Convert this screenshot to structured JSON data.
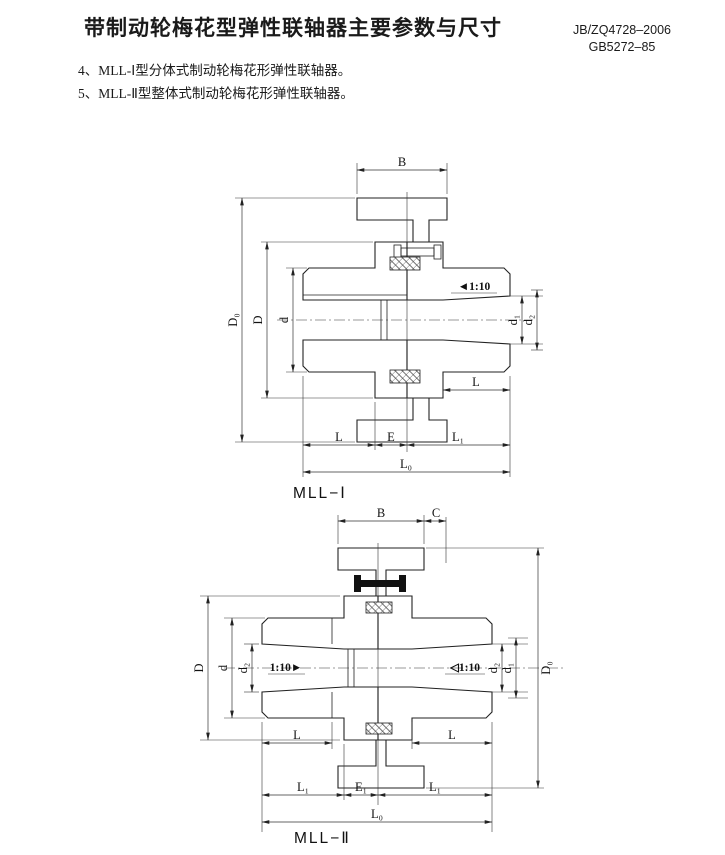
{
  "page": {
    "title": "带制动轮梅花型弹性联轴器主要参数与尺寸",
    "standards": [
      "JB/ZQ4728–2006",
      "GB5272–85"
    ]
  },
  "notes": [
    "4、MLL-Ⅰ型分体式制动轮梅花形弹性联轴器。",
    "5、MLL-Ⅱ型整体式制动轮梅花形弹性联轴器。"
  ],
  "colors": {
    "ink": "#1a1a1a",
    "paper": "#ffffff"
  },
  "drawing1": {
    "caption": "MLL−Ⅰ",
    "labels": {
      "B": "B",
      "D0": "D₀",
      "D": "D",
      "d": "d",
      "taper": "◄1:10",
      "d1": "d₁",
      "d2": "d₂",
      "L_hub": "L",
      "L": "L",
      "E": "E",
      "L1": "L₁",
      "L0": "L₀"
    }
  },
  "drawing2": {
    "caption": "MLL−Ⅱ",
    "labels": {
      "B": "B",
      "C": "C",
      "D": "D",
      "d": "d",
      "d2_left": "d₂",
      "taper_left": "1:10►",
      "taper_right": "◁1:10",
      "d2_right": "d₂",
      "d1": "d₁",
      "D0": "D₀",
      "L_left": "L",
      "L_right": "L",
      "L1_left": "L₁",
      "E1": "E₁",
      "L1_right": "L₁",
      "L0": "L₀"
    }
  }
}
